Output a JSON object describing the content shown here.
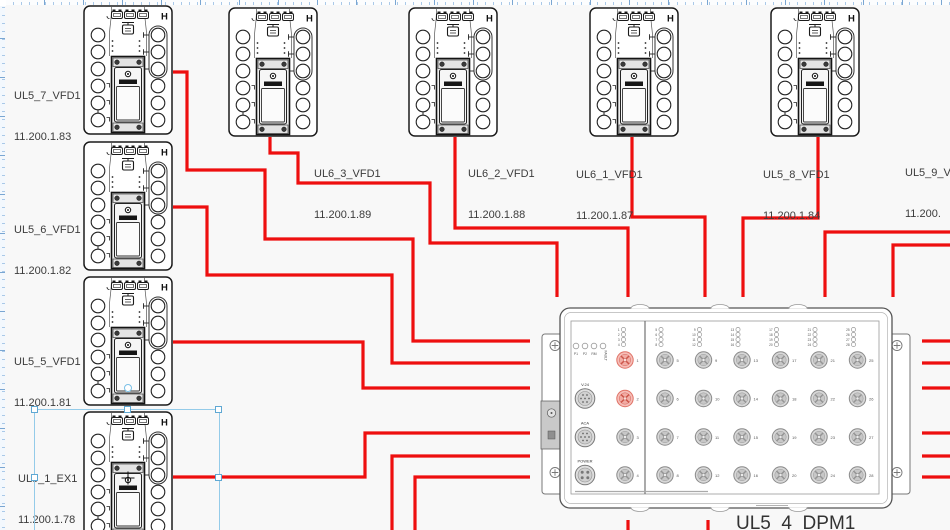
{
  "canvas": {
    "background": "#f8f8f8",
    "cable_color": "#ee0f0f",
    "selection_color": "#94cbe9"
  },
  "devices": [
    {
      "name": "UL5_7_VFD1",
      "ip": "11.200.1.83",
      "type": "vfd-drive"
    },
    {
      "name": "UL5_6_VFD1",
      "ip": "11.200.1.82",
      "type": "vfd-drive"
    },
    {
      "name": "UL5_5_VFD1",
      "ip": "11.200.1.81",
      "type": "vfd-drive"
    },
    {
      "name": "UL5_1_EX1",
      "ip": "11.200.1.78",
      "type": "vfd-drive",
      "selected": true
    },
    {
      "name": "UL6_3_VFD1",
      "ip": "11.200.1.89",
      "type": "vfd-drive"
    },
    {
      "name": "UL6_2_VFD1",
      "ip": "11.200.1.88",
      "type": "vfd-drive"
    },
    {
      "name": "UL6_1_VFD1",
      "ip": "11.200.1.87",
      "type": "vfd-drive"
    },
    {
      "name": "UL5_8_VFD1",
      "ip": "11.200.1.84",
      "type": "vfd-drive"
    },
    {
      "name": "UL5_9_V",
      "ip": "11.200.",
      "type": "vfd-drive",
      "clipped": true
    }
  ],
  "dpm": {
    "label": "UL5_4_DPM1",
    "status_leds": [
      "P1",
      "P2",
      "RM",
      "FAULT"
    ],
    "connectors": [
      "V.24",
      "ACA",
      "POWER"
    ],
    "ports": [
      "1",
      "2",
      "3",
      "4",
      "5",
      "6",
      "7",
      "8",
      "9",
      "10",
      "11",
      "12",
      "13",
      "14",
      "15",
      "16",
      "17",
      "18",
      "19",
      "20",
      "21",
      "22",
      "23",
      "24",
      "25",
      "26",
      "27",
      "28"
    ],
    "highlighted_ports": [
      "1",
      "2"
    ]
  },
  "cables": [
    {
      "id": "ul5_7-dpm",
      "points": [
        [
          173,
          72
        ],
        [
          187,
          72
        ],
        [
          187,
          170
        ],
        [
          265,
          170
        ],
        [
          265,
          239
        ],
        [
          413,
          239
        ],
        [
          413,
          341
        ],
        [
          950,
          341
        ]
      ]
    },
    {
      "id": "ul5_6-dpm",
      "points": [
        [
          173,
          207
        ],
        [
          207,
          207
        ],
        [
          207,
          275
        ],
        [
          392,
          275
        ],
        [
          392,
          363
        ],
        [
          950,
          363
        ]
      ]
    },
    {
      "id": "ul5_5-dpm",
      "points": [
        [
          173,
          342
        ],
        [
          363,
          342
        ],
        [
          363,
          388
        ],
        [
          950,
          388
        ]
      ]
    },
    {
      "id": "ul5_1-dpm",
      "points": [
        [
          173,
          477
        ],
        [
          365,
          477
        ],
        [
          365,
          433
        ],
        [
          950,
          433
        ]
      ]
    },
    {
      "id": "bottom-a",
      "points": [
        [
          392,
          530
        ],
        [
          392,
          456
        ],
        [
          950,
          456
        ]
      ]
    },
    {
      "id": "bottom-b",
      "points": [
        [
          415,
          530
        ],
        [
          415,
          477
        ],
        [
          950,
          477
        ]
      ]
    },
    {
      "id": "ul6_3-dpm",
      "points": [
        [
          270,
          137
        ],
        [
          270,
          153
        ],
        [
          298,
          153
        ],
        [
          298,
          183
        ],
        [
          430,
          183
        ],
        [
          430,
          243
        ],
        [
          557,
          243
        ],
        [
          557,
          297
        ]
      ]
    },
    {
      "id": "ul6_2-dpm",
      "points": [
        [
          455,
          137
        ],
        [
          455,
          228
        ],
        [
          628,
          228
        ],
        [
          628,
          297
        ]
      ]
    },
    {
      "id": "ul6_1-dpm",
      "points": [
        [
          632,
          137
        ],
        [
          632,
          217
        ],
        [
          705,
          217
        ],
        [
          705,
          297
        ]
      ]
    },
    {
      "id": "ul5_8-dpm",
      "points": [
        [
          818,
          137
        ],
        [
          818,
          218
        ],
        [
          743,
          218
        ],
        [
          743,
          297
        ]
      ]
    },
    {
      "id": "right-a-dpm",
      "points": [
        [
          950,
          232
        ],
        [
          825,
          232
        ],
        [
          825,
          297
        ]
      ]
    },
    {
      "id": "right-b-dpm",
      "points": [
        [
          950,
          245
        ],
        [
          893,
          245
        ],
        [
          893,
          297
        ]
      ]
    },
    {
      "id": "dpm-bottom-a",
      "points": [
        [
          628,
          520
        ],
        [
          628,
          530
        ]
      ]
    },
    {
      "id": "dpm-bottom-b",
      "points": [
        [
          708,
          520
        ],
        [
          708,
          530
        ]
      ]
    }
  ]
}
